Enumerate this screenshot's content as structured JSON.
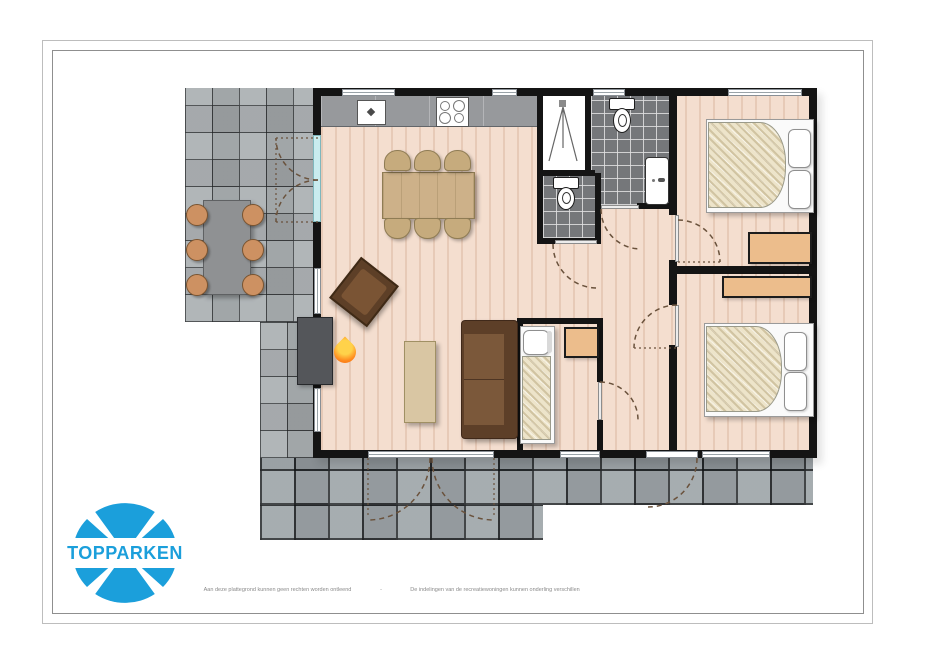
{
  "page": {
    "background": "#ffffff",
    "frame_outer_color": "#bdbdbd",
    "frame_inner_color": "#8f8f8f"
  },
  "logo": {
    "text": "TOPPARKEN",
    "color": "#1b9fdb"
  },
  "footer": {
    "left_note": "Aan deze plattegrond kunnen geen rechten worden ontleend",
    "separator": "-",
    "right_note": "De indelingen van de recreatiewoningen kunnen onderling verschillen"
  },
  "floorplan": {
    "colors": {
      "wall": "#141414",
      "wood_floor": "#f4decf",
      "terrace_tile": "#a7acaf",
      "patio_tile": "#9aa1a5",
      "bathroom_tile": "#75777a",
      "wardrobe": "#ecbd8c",
      "sofa": "#6b4930",
      "table_wood": "#cdb189",
      "flame_accent": "#ff8c1f",
      "door_glass": "#c9ecef",
      "door_swing_dash": "#6a523c"
    },
    "rooms": [
      "terrace-left",
      "terrace-bottom",
      "living-room",
      "kitchen",
      "shower-room",
      "bathroom",
      "toilet-room",
      "hallway",
      "bedroom-1",
      "bedroom-2",
      "bedroom-3"
    ],
    "furniture": [
      "outdoor-table",
      "outdoor-chairs",
      "kitchen-counter",
      "sink",
      "stove",
      "dining-table",
      "dining-chairs",
      "armchair",
      "fireplace",
      "coffee-table",
      "sofa",
      "single-bed",
      "cabinet",
      "double-bed-1",
      "wardrobe-1",
      "double-bed-2",
      "wardrobe-2",
      "toilets",
      "washbasin",
      "shower"
    ]
  }
}
